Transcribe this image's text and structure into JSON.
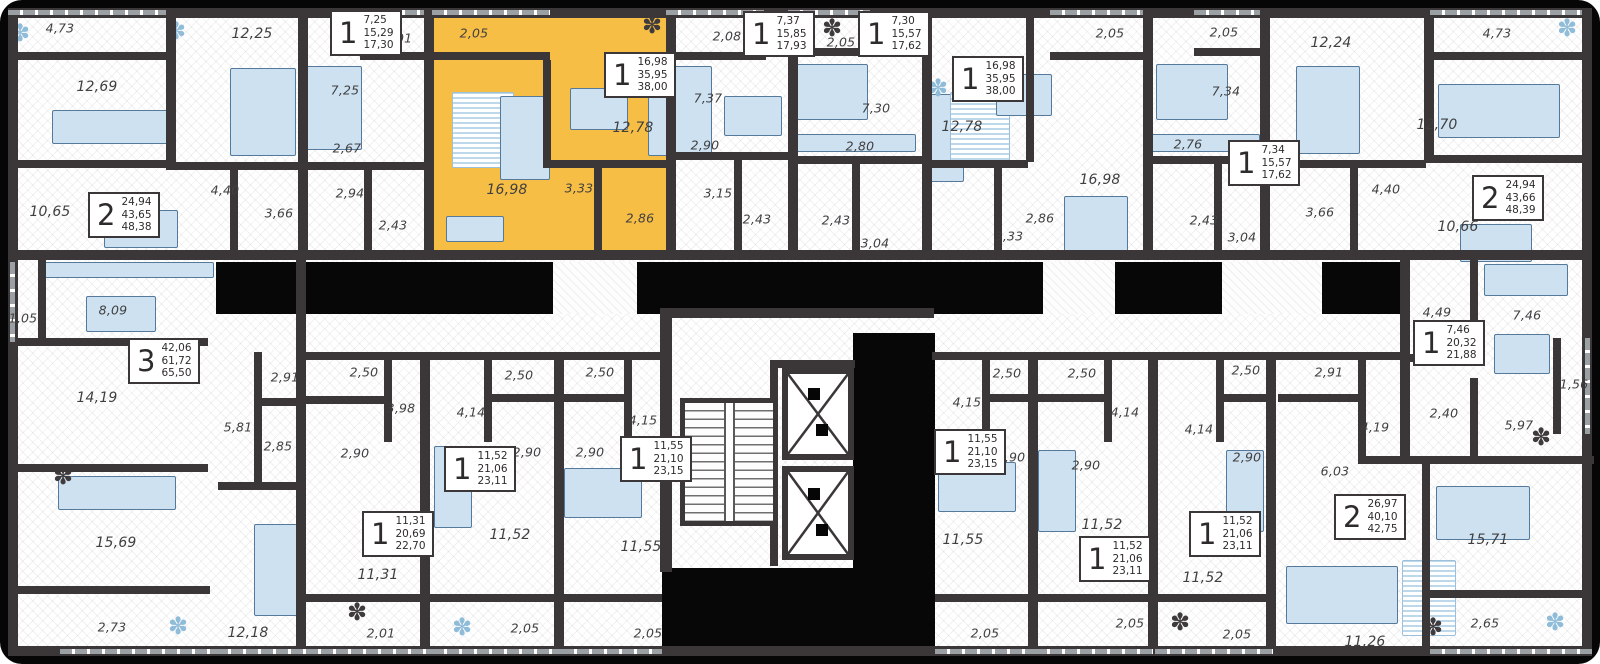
{
  "colors": {
    "background": "#060606",
    "wall": "#3b3638",
    "floor": "#ffffff",
    "highlight_apartment": "#F7BE45",
    "furniture": "#cde1f0",
    "label_text": "#403f41"
  },
  "icons": {
    "plant": "✽"
  },
  "highlighted_apartment": {
    "rooms": "1",
    "living_area": "16,98",
    "apartment_area": "35,95",
    "total_area": "38,00"
  },
  "room_labels": [
    {
      "t": "4,73",
      "x": 60,
      "y": 28
    },
    {
      "t": "12,69",
      "x": 97,
      "y": 87
    },
    {
      "t": "12,25",
      "x": 252,
      "y": 34
    },
    {
      "t": "10,65",
      "x": 50,
      "y": 212
    },
    {
      "t": "4,40",
      "x": 225,
      "y": 190
    },
    {
      "t": "3,66",
      "x": 279,
      "y": 213
    },
    {
      "t": "2,01",
      "x": 398,
      "y": 38
    },
    {
      "t": "7,25",
      "x": 345,
      "y": 90
    },
    {
      "t": "2,67",
      "x": 347,
      "y": 148
    },
    {
      "t": "2,94",
      "x": 350,
      "y": 193
    },
    {
      "t": "2,43",
      "x": 393,
      "y": 225
    },
    {
      "t": "2,05",
      "x": 474,
      "y": 33
    },
    {
      "t": "16,98",
      "x": 507,
      "y": 190
    },
    {
      "t": "3,33",
      "x": 579,
      "y": 188
    },
    {
      "t": "12,78",
      "x": 633,
      "y": 128
    },
    {
      "t": "2,86",
      "x": 640,
      "y": 218
    },
    {
      "t": "2,08",
      "x": 727,
      "y": 36
    },
    {
      "t": "7,37",
      "x": 708,
      "y": 98
    },
    {
      "t": "2,90",
      "x": 705,
      "y": 145
    },
    {
      "t": "3,15",
      "x": 718,
      "y": 193
    },
    {
      "t": "2,43",
      "x": 757,
      "y": 219
    },
    {
      "t": "2,05",
      "x": 841,
      "y": 42
    },
    {
      "t": "7,30",
      "x": 876,
      "y": 108
    },
    {
      "t": "2,80",
      "x": 860,
      "y": 146
    },
    {
      "t": "2,43",
      "x": 836,
      "y": 220
    },
    {
      "t": "3,04",
      "x": 875,
      "y": 243
    },
    {
      "t": "2,05",
      "x": 1110,
      "y": 33
    },
    {
      "t": "12,78",
      "x": 962,
      "y": 127
    },
    {
      "t": "16,98",
      "x": 1100,
      "y": 180
    },
    {
      "t": "3,33",
      "x": 1009,
      "y": 236
    },
    {
      "t": "2,86",
      "x": 1040,
      "y": 218
    },
    {
      "t": "2,05",
      "x": 1224,
      "y": 32
    },
    {
      "t": "7,34",
      "x": 1226,
      "y": 91
    },
    {
      "t": "2,76",
      "x": 1188,
      "y": 144
    },
    {
      "t": "2,43",
      "x": 1204,
      "y": 220
    },
    {
      "t": "3,04",
      "x": 1242,
      "y": 237
    },
    {
      "t": "12,24",
      "x": 1331,
      "y": 43
    },
    {
      "t": "4,73",
      "x": 1497,
      "y": 33
    },
    {
      "t": "12,70",
      "x": 1437,
      "y": 125
    },
    {
      "t": "4,40",
      "x": 1386,
      "y": 189
    },
    {
      "t": "3,66",
      "x": 1320,
      "y": 212
    },
    {
      "t": "10,66",
      "x": 1458,
      "y": 227
    },
    {
      "t": "1,05",
      "x": 23,
      "y": 318
    },
    {
      "t": "8,09",
      "x": 113,
      "y": 310
    },
    {
      "t": "14,19",
      "x": 97,
      "y": 398
    },
    {
      "t": "15,69",
      "x": 116,
      "y": 543
    },
    {
      "t": "2,73",
      "x": 112,
      "y": 627
    },
    {
      "t": "12,18",
      "x": 248,
      "y": 633
    },
    {
      "t": "5,81",
      "x": 238,
      "y": 427
    },
    {
      "t": "2,85",
      "x": 278,
      "y": 446
    },
    {
      "t": "2,91",
      "x": 285,
      "y": 377
    },
    {
      "t": "2,50",
      "x": 364,
      "y": 372
    },
    {
      "t": "3,98",
      "x": 401,
      "y": 408
    },
    {
      "t": "2,90",
      "x": 355,
      "y": 453
    },
    {
      "t": "11,31",
      "x": 378,
      "y": 575
    },
    {
      "t": "2,01",
      "x": 381,
      "y": 633
    },
    {
      "t": "2,50",
      "x": 519,
      "y": 375
    },
    {
      "t": "4,14",
      "x": 471,
      "y": 412
    },
    {
      "t": "2,90",
      "x": 527,
      "y": 452
    },
    {
      "t": "11,52",
      "x": 510,
      "y": 535
    },
    {
      "t": "2,05",
      "x": 525,
      "y": 628
    },
    {
      "t": "2,50",
      "x": 600,
      "y": 372
    },
    {
      "t": "4,15",
      "x": 643,
      "y": 420
    },
    {
      "t": "2,90",
      "x": 590,
      "y": 452
    },
    {
      "t": "11,55",
      "x": 641,
      "y": 547
    },
    {
      "t": "2,05",
      "x": 648,
      "y": 633
    },
    {
      "t": "2,50",
      "x": 1007,
      "y": 373
    },
    {
      "t": "4,15",
      "x": 967,
      "y": 402
    },
    {
      "t": "2,90",
      "x": 1011,
      "y": 457
    },
    {
      "t": "11,55",
      "x": 963,
      "y": 540
    },
    {
      "t": "2,05",
      "x": 985,
      "y": 633
    },
    {
      "t": "2,50",
      "x": 1082,
      "y": 373
    },
    {
      "t": "4,14",
      "x": 1125,
      "y": 412
    },
    {
      "t": "2,90",
      "x": 1086,
      "y": 465
    },
    {
      "t": "11,52",
      "x": 1102,
      "y": 525
    },
    {
      "t": "2,05",
      "x": 1130,
      "y": 623
    },
    {
      "t": "2,50",
      "x": 1246,
      "y": 370
    },
    {
      "t": "4,14",
      "x": 1199,
      "y": 429
    },
    {
      "t": "2,90",
      "x": 1247,
      "y": 457
    },
    {
      "t": "11,52",
      "x": 1203,
      "y": 578
    },
    {
      "t": "2,05",
      "x": 1237,
      "y": 634
    },
    {
      "t": "2,91",
      "x": 1329,
      "y": 372
    },
    {
      "t": "4,19",
      "x": 1375,
      "y": 427
    },
    {
      "t": "6,03",
      "x": 1335,
      "y": 471
    },
    {
      "t": "15,71",
      "x": 1488,
      "y": 540
    },
    {
      "t": "11,26",
      "x": 1365,
      "y": 642
    },
    {
      "t": "2,65",
      "x": 1485,
      "y": 623
    },
    {
      "t": "4,49",
      "x": 1437,
      "y": 312
    },
    {
      "t": "7,46",
      "x": 1527,
      "y": 315
    },
    {
      "t": "2,40",
      "x": 1444,
      "y": 413
    },
    {
      "t": "5,97",
      "x": 1519,
      "y": 425
    },
    {
      "t": "1,56",
      "x": 1574,
      "y": 384
    }
  ],
  "stat_blocks": [
    {
      "rooms": "2",
      "living": "24,94",
      "area": "43,65",
      "total": "48,38",
      "x": 88,
      "y": 192
    },
    {
      "rooms": "1",
      "living": "7,25",
      "area": "15,29",
      "total": "17,30",
      "x": 330,
      "y": 10
    },
    {
      "rooms": "1",
      "living": "16,98",
      "area": "35,95",
      "total": "38,00",
      "x": 604,
      "y": 52,
      "highlighted": true
    },
    {
      "rooms": "1",
      "living": "7,37",
      "area": "15,85",
      "total": "17,93",
      "x": 743,
      "y": 11
    },
    {
      "rooms": "1",
      "living": "7,30",
      "area": "15,57",
      "total": "17,62",
      "x": 858,
      "y": 11
    },
    {
      "rooms": "1",
      "living": "16,98",
      "area": "35,95",
      "total": "38,00",
      "x": 952,
      "y": 56
    },
    {
      "rooms": "1",
      "living": "7,34",
      "area": "15,57",
      "total": "17,62",
      "x": 1228,
      "y": 140
    },
    {
      "rooms": "2",
      "living": "24,94",
      "area": "43,66",
      "total": "48,39",
      "x": 1472,
      "y": 175
    },
    {
      "rooms": "3",
      "living": "42,06",
      "area": "61,72",
      "total": "65,50",
      "x": 128,
      "y": 338
    },
    {
      "rooms": "1",
      "living": "11,31",
      "area": "20,69",
      "total": "22,70",
      "x": 362,
      "y": 511
    },
    {
      "rooms": "1",
      "living": "11,52",
      "area": "21,06",
      "total": "23,11",
      "x": 444,
      "y": 446
    },
    {
      "rooms": "1",
      "living": "11,55",
      "area": "21,10",
      "total": "23,15",
      "x": 620,
      "y": 436
    },
    {
      "rooms": "1",
      "living": "11,55",
      "area": "21,10",
      "total": "23,15",
      "x": 934,
      "y": 429
    },
    {
      "rooms": "1",
      "living": "11,52",
      "area": "21,06",
      "total": "23,11",
      "x": 1079,
      "y": 536
    },
    {
      "rooms": "1",
      "living": "11,52",
      "area": "21,06",
      "total": "23,11",
      "x": 1189,
      "y": 511
    },
    {
      "rooms": "2",
      "living": "26,97",
      "area": "40,10",
      "total": "42,75",
      "x": 1334,
      "y": 494
    },
    {
      "rooms": "1",
      "living": "7,46",
      "area": "20,32",
      "total": "21,88",
      "x": 1413,
      "y": 320
    }
  ]
}
